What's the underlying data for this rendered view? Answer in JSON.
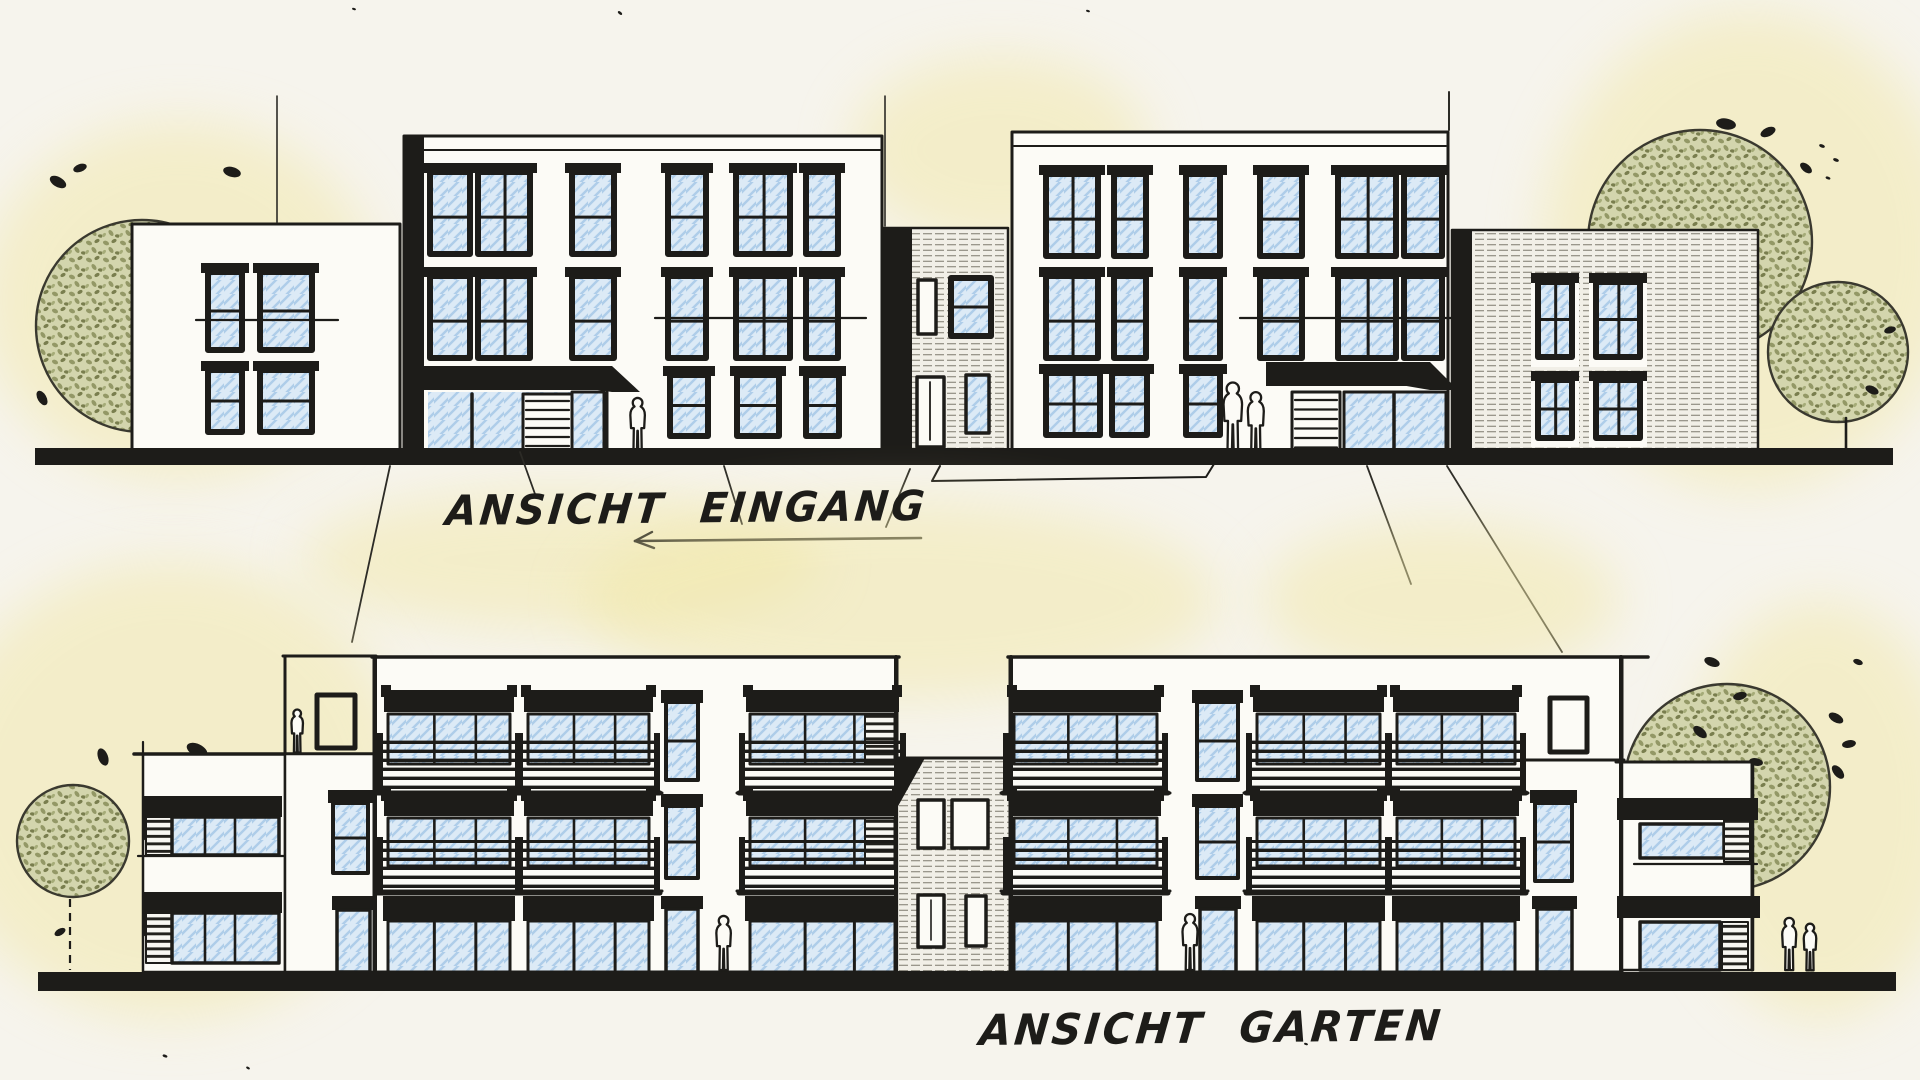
{
  "document": {
    "type": "architectural elevation sketch",
    "style": "hand-drawn ink marker with colored pencil on cream paper",
    "views": [
      "entrance elevation",
      "garden elevation"
    ]
  },
  "labels": {
    "top_elevation": "ANSICHT EINGANG",
    "bottom_elevation": "ANSICHT GARTEN"
  },
  "palette": {
    "paper": "#f6f4ed",
    "facade_white": "#fcfbf6",
    "ink": "#1d1c19",
    "line": "#2c2b26",
    "glass_fill": "#dceaf6",
    "glass_hatch": "#aecde9",
    "wood_fill": "#f1efe7",
    "wood_line": "#7d7a6e",
    "louver_bg": "#f7f6f1",
    "foliage_base": "#d3d5ad",
    "foliage_mid": "#939866",
    "foliage_dark": "#797e4e",
    "wash_yellow": "#f1e7a6"
  },
  "scene": {
    "top_elevation": {
      "label": "ANSICHT EINGANG",
      "buildings": [
        "2-storey house (left)",
        "3-storey apartment block with entrance canopy",
        "2-storey timber-clad link",
        "3-storey apartment block with entrance canopy",
        "2-storey timber-clad house (right)"
      ],
      "trees": 3,
      "figures": 3,
      "annotations": [
        "leader lines to label",
        "dimension bracket under right block",
        "underline below EINGANG"
      ]
    },
    "bottom_elevation": {
      "label": "ANSICHT GARTEN",
      "buildings": [
        "2-storey wing with shaded loggias (left)",
        "3-storey block with balconies and roof terrace",
        "2-storey timber-clad link",
        "3-storey block with balconies and roof terrace",
        "2-storey wing with shaded loggias (right)"
      ],
      "trees": 2,
      "figures": 5
    }
  }
}
